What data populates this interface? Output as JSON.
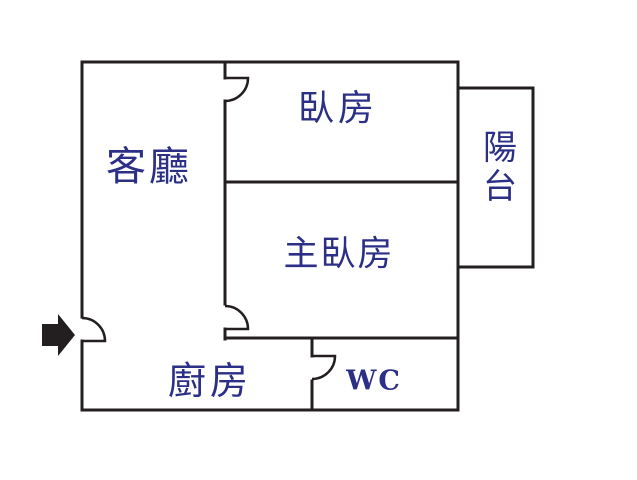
{
  "colors": {
    "wall": "#231f20",
    "label": "#2b2f85",
    "background": "#ffffff"
  },
  "rooms": {
    "living_room": {
      "label": "客廳"
    },
    "bedroom": {
      "label": "臥房"
    },
    "master_bedroom": {
      "label": "主臥房"
    },
    "balcony": {
      "label": "陽台"
    },
    "kitchen": {
      "label": "廚房"
    },
    "wc": {
      "label": "WC"
    }
  },
  "entrance": {
    "icon": "entrance-arrow-icon"
  }
}
